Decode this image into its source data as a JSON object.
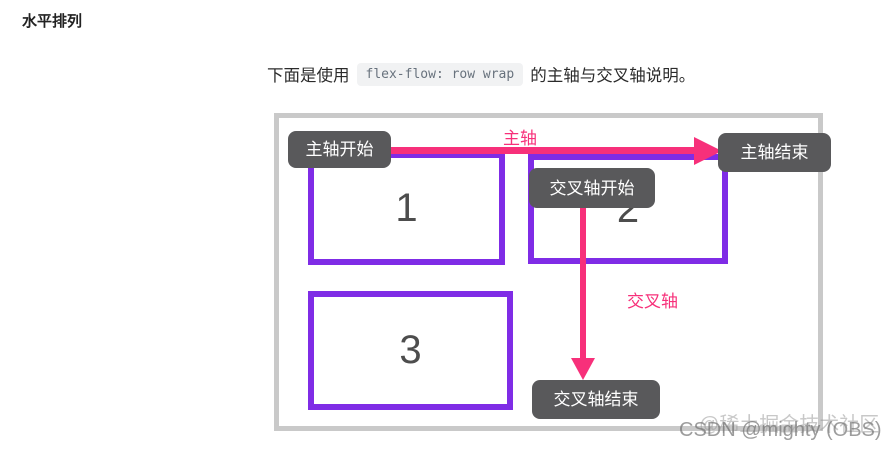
{
  "page": {
    "heading": "水平排列",
    "intro": {
      "prefix": "下面是使用",
      "code": "flex-flow: row wrap",
      "suffix": "的主轴与交叉轴说明。"
    }
  },
  "diagram": {
    "axis_labels": {
      "main_axis": "主轴",
      "main_axis_start": "主轴开始",
      "main_axis_end": "主轴结束",
      "cross_axis": "交叉轴",
      "cross_axis_start": "交叉轴开始",
      "cross_axis_end": "交叉轴结束"
    },
    "items": [
      {
        "number": "1"
      },
      {
        "number": "2"
      },
      {
        "number": "3"
      }
    ],
    "colors": {
      "axis_arrow_pink": "#f7307a",
      "item_border_purple": "#7f2ce6",
      "label_background": "#59595b",
      "label_text": "#ffffff",
      "frame_border": "#c9c9c9"
    }
  },
  "watermarks": {
    "juejin": "@稀土掘金技术社区",
    "csdn": "CSDN @mighty (OBS)"
  }
}
